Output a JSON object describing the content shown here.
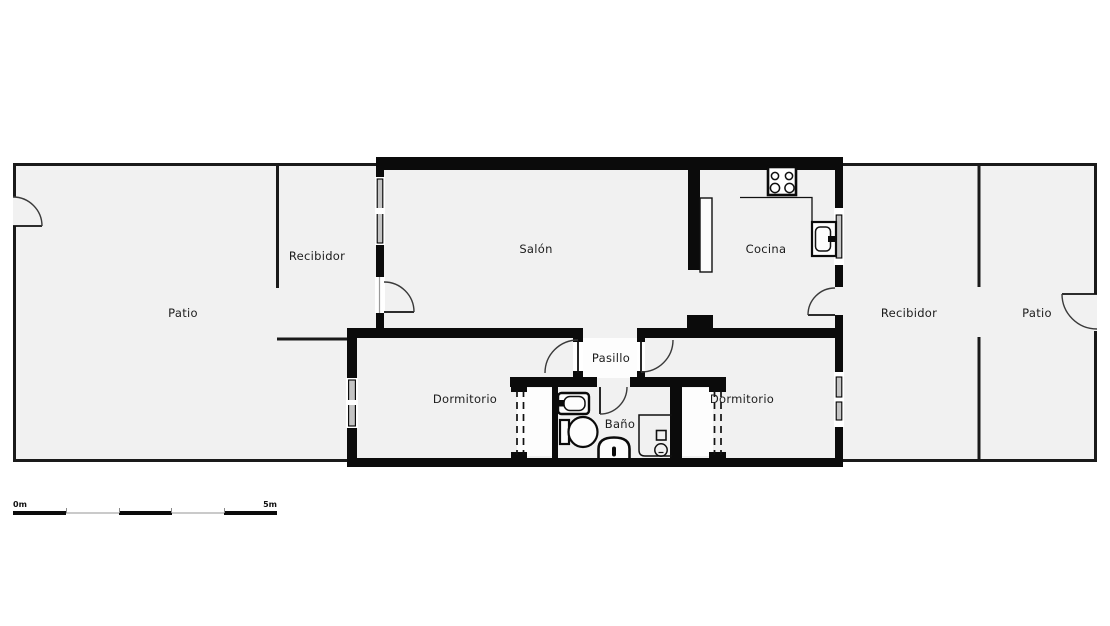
{
  "diagram_type": "floor-plan",
  "colors": {
    "background": "#ffffff",
    "floor": "#f1f1f1",
    "corridor_floor": "#fdfdfd",
    "wall": "#0b0b0b",
    "door_line": "#3a3a3a",
    "window_glass": "#c4c4c4"
  },
  "rooms": {
    "patio_left": "Patio",
    "recibidor_left": "Recibidor",
    "salon": "Salón",
    "cocina": "Cocina",
    "recibidor_right": "Recibidor",
    "patio_right": "Patio",
    "dormitorio_left": "Dormitorio",
    "pasillo": "Pasillo",
    "bano": "Baño",
    "dormitorio_right": "Dormitorio"
  },
  "fixtures": {
    "stove": "stove-icon",
    "kitchen_counter": "counter-line",
    "kitchen_sink": "kitchen-sink-icon",
    "kitchen_cabinet": "cabinet-leaf",
    "bathroom_sink": "bathroom-sink-icon",
    "toilet": "toilet-icon",
    "bidet": "bidet-icon",
    "shower": "shower-icon",
    "wardrobe_left": "dashed-wardrobe",
    "wardrobe_right": "dashed-wardrobe"
  },
  "scale_bar": {
    "start_label": "0m",
    "end_label": "5m",
    "segments": 5
  }
}
